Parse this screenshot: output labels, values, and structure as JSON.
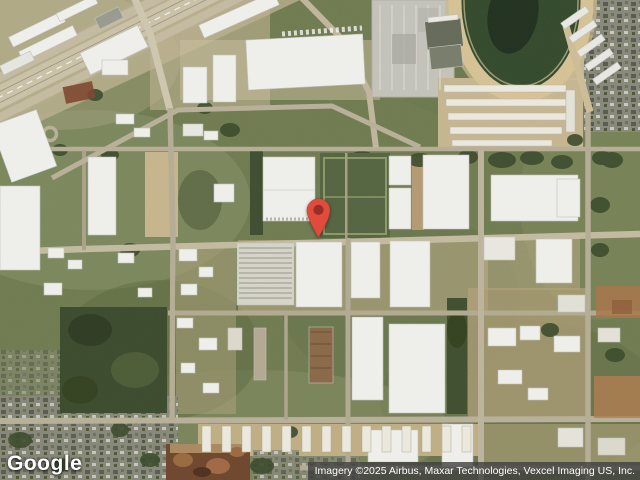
{
  "map": {
    "provider_logo": "Google",
    "attribution": "Imagery ©2025 Airbus, Maxar Technologies, Vexcel Imaging US, Inc."
  },
  "marker": {
    "name": "red-location-pin",
    "color": "#E04B3B",
    "dot_color": "#962F25"
  },
  "ui_colors": {
    "attribution_bar": "#404040",
    "logo_text": "#FFFFFF"
  }
}
